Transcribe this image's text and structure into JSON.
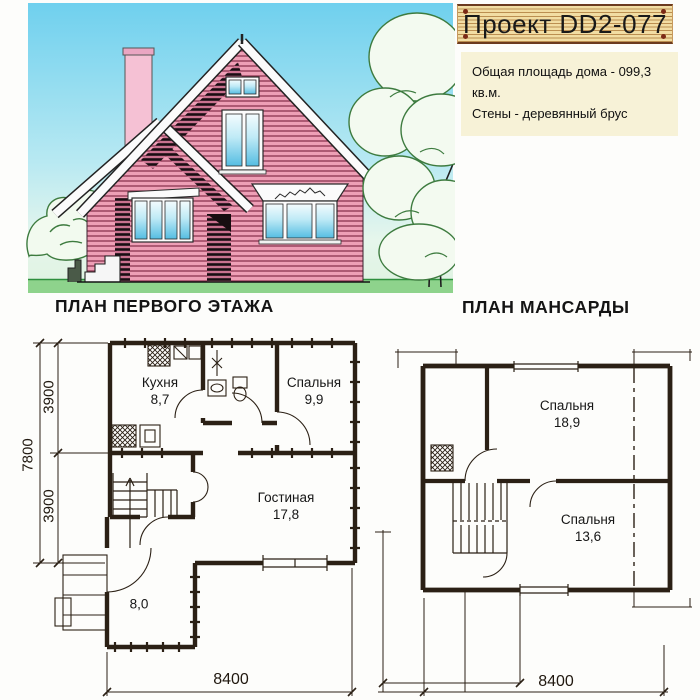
{
  "title_plate": {
    "text": "Проект DD2-077"
  },
  "info_panel": {
    "line1": "Общая площадь дома - 099,3 кв.м.",
    "line2": "Стены - деревянный брус"
  },
  "first_floor": {
    "heading": "ПЛАН ПЕРВОГО ЭТАЖА",
    "rooms": [
      {
        "name": "Кухня",
        "area": "8,7"
      },
      {
        "name": "Спальня",
        "area": "9,9"
      },
      {
        "name": "Гостиная",
        "area": "17,8"
      },
      {
        "name": "",
        "area": "8,0"
      }
    ],
    "dims": {
      "total": "7800",
      "upper": "3900",
      "lower": "3900",
      "width": "8400"
    }
  },
  "attic": {
    "heading": "ПЛАН МАНСАРДЫ",
    "rooms": [
      {
        "name": "Спальня",
        "area": "18,9"
      },
      {
        "name": "Спальня",
        "area": "13,6"
      }
    ],
    "dims": {
      "width": "8400"
    }
  },
  "colors": {
    "siding_pink": "#ee9fb6",
    "sky_blue": "#6fd0ee",
    "grass_green": "#8ed38c",
    "plank_tan": "#f2dda3",
    "info_cream": "#f7f2d7",
    "ink": "#2b2015"
  }
}
